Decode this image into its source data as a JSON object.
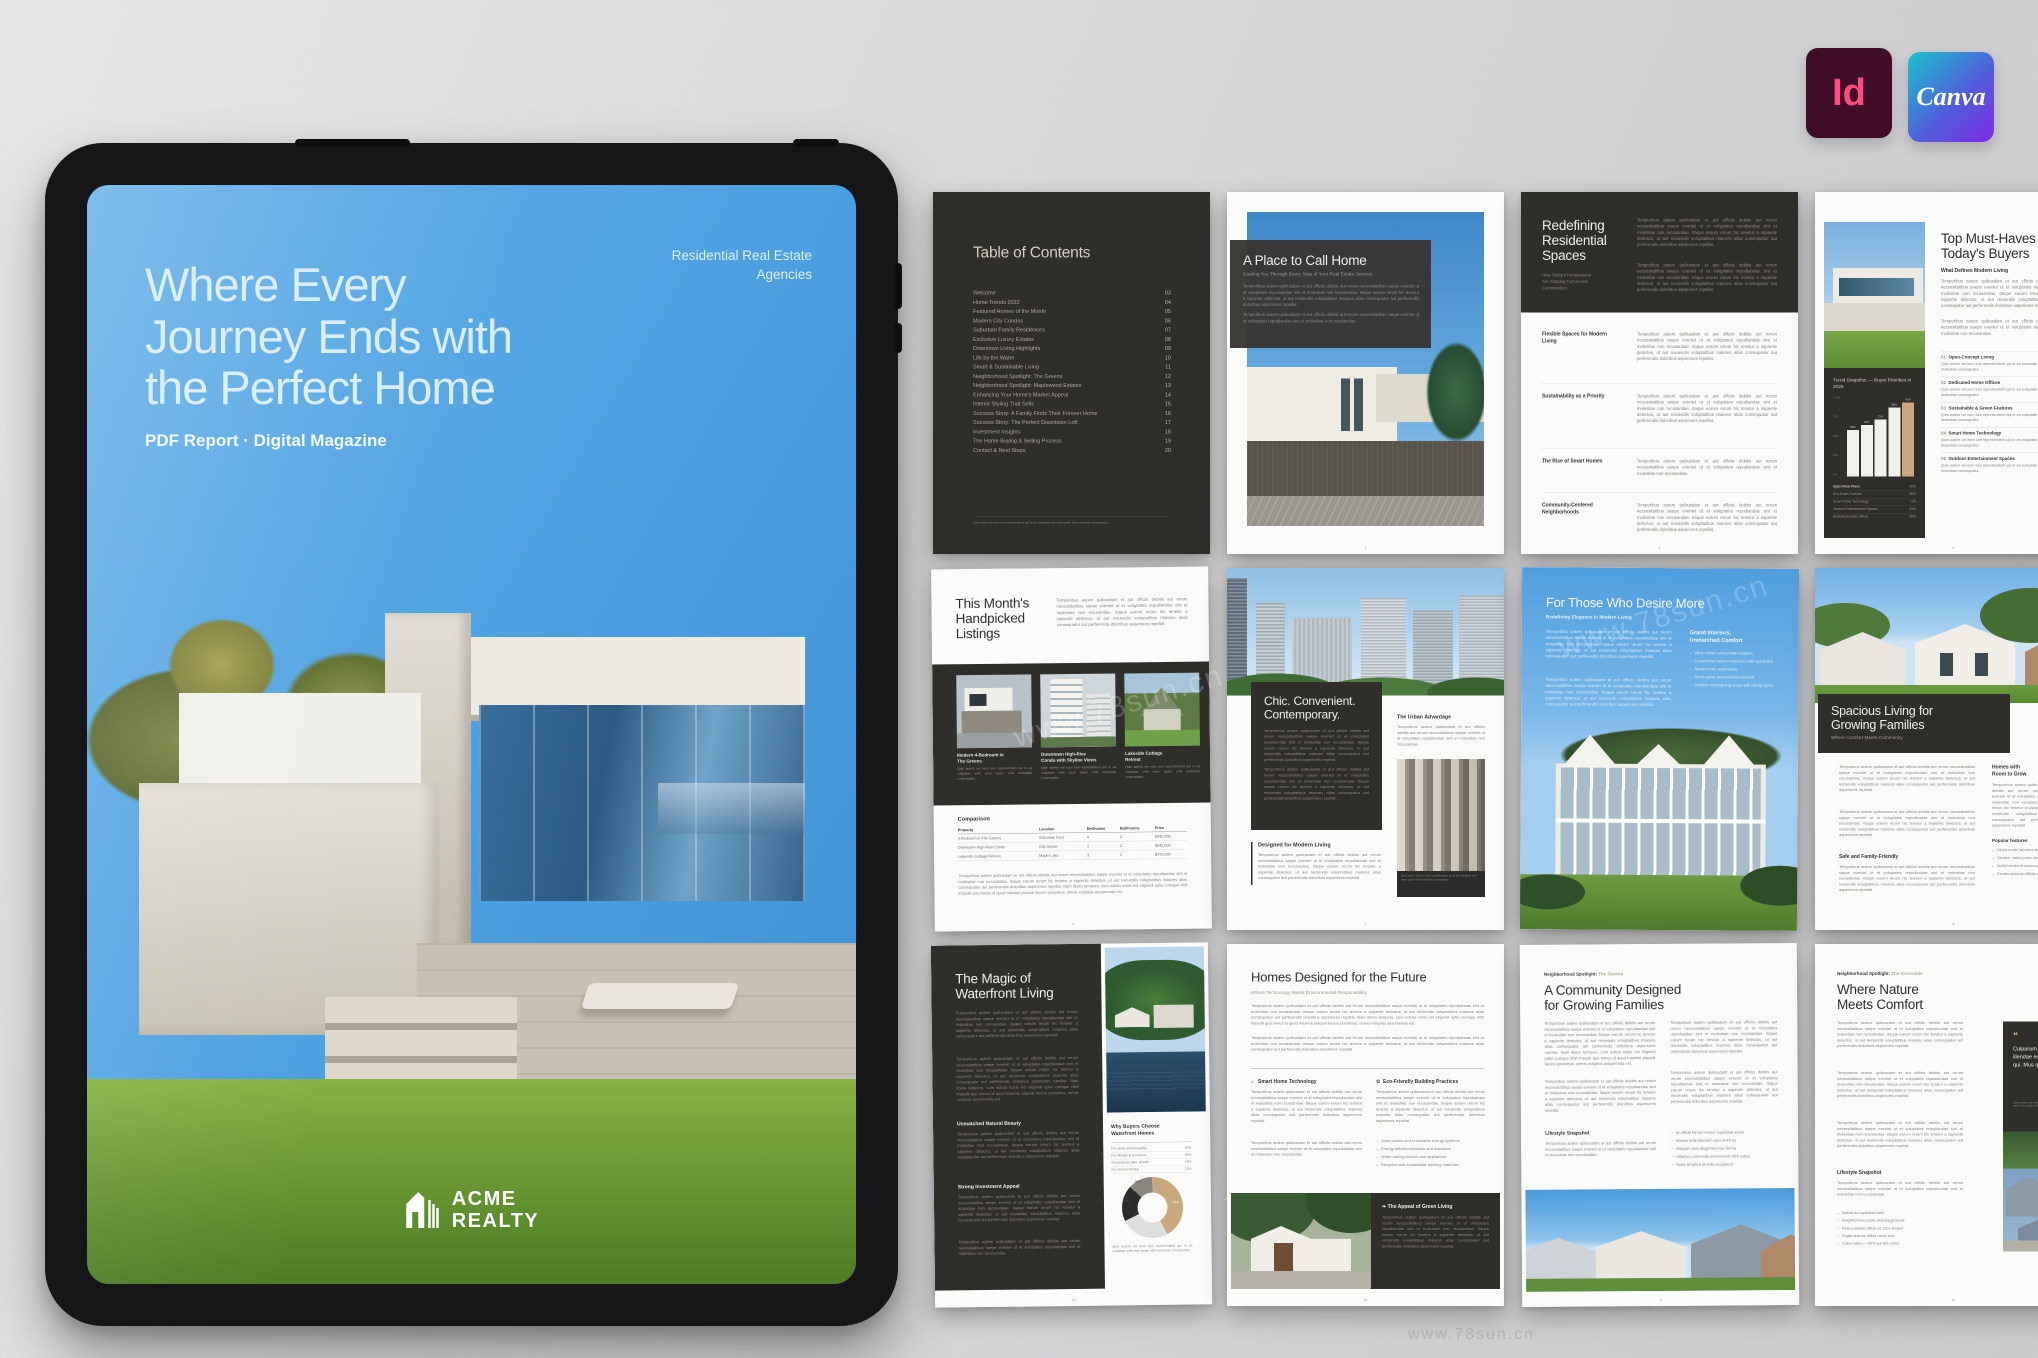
{
  "palette": {
    "accent_tan": "#c8a87e",
    "page_dark": "#302e2b",
    "sky_blue": "#4b9fe0"
  },
  "watermark": {
    "text": "www.78sun.cn"
  },
  "logos": {
    "indesign_label": "Id",
    "canva_label": "Canva"
  },
  "cover": {
    "title_lines": [
      "Where Every",
      "Journey Ends with",
      "the Perfect Home"
    ],
    "tagline": "PDF Report · Digital Magazine",
    "agency_lines": [
      "Residential Real Estate",
      "Agencies"
    ],
    "brand_line1": "ACME",
    "brand_line2": "REALTY"
  },
  "lorem": {
    "tiny": "Quis autem vel eum iure reprehenderit qui in ea voluptate velit esse quam nihil molestiae consequatur.",
    "s": "Temporibus autem quibusdam et aut officiis debitis aut rerum necessitatibus saepe eveniet ut et voluptates repudiandae sint et molestiae non recusandae.",
    "m": "Temporibus autem quibusdam et aut officiis debitis aut rerum necessitatibus saepe eveniet ut et voluptates repudiandae sint et molestiae non recusandae. Itaque earum rerum hic tenetur a sapiente delectus, ut aut reiciendis voluptatibus maiores alias consequatur aut perferendis doloribus asperiores repellat.",
    "l": "Temporibus autem quibusdam et aut officiis debitis aut rerum necessitatibus saepe eveniet ut et voluptates repudiandae sint et molestiae non recusandae. Itaque earum rerum hic tenetur a sapiente delectus, ut aut reiciendis voluptatibus maiores alias consequatur aut perferendis doloribus asperiores repellat. Nam libero tempore, cum soluta nobis est eligendi optio cumque nihil impedit quo minus id quod maxime placeat facere possimus, omnis voluptas assumenda est."
  },
  "toc": {
    "title": "Table of Contents",
    "items": [
      {
        "label": "Welcome",
        "page": "03"
      },
      {
        "label": "Home Trends 2032",
        "page": "04"
      },
      {
        "label": "Featured Homes of the Month",
        "page": "05"
      },
      {
        "label": "Modern City Condos",
        "page": "06"
      },
      {
        "label": "Suburban Family Residences",
        "page": "07"
      },
      {
        "label": "Exclusive Luxury Estates",
        "page": "08"
      },
      {
        "label": "Downtown Living Highlights",
        "page": "09"
      },
      {
        "label": "Life by the Water",
        "page": "10"
      },
      {
        "label": "Smart & Sustainable Living",
        "page": "11"
      },
      {
        "label": "Neighborhood Spotlight: The Greens",
        "page": "12"
      },
      {
        "label": "Neighborhood Spotlight: Maplewood Estates",
        "page": "13"
      },
      {
        "label": "Enhancing Your Home's Market Appeal",
        "page": "14"
      },
      {
        "label": "Interior Styling That Sells",
        "page": "15"
      },
      {
        "label": "Success Story: A Family Finds Their Forever Home",
        "page": "16"
      },
      {
        "label": "Success Story: The Perfect Downtown Loft",
        "page": "17"
      },
      {
        "label": "Investment Insights",
        "page": "18"
      },
      {
        "label": "The Home Buying & Selling Process",
        "page": "19"
      },
      {
        "label": "Contact & Next Steps",
        "page": "20"
      }
    ]
  },
  "place": {
    "title": "A Place to Call Home",
    "subtitle": "Guiding You Through Every Step of Your Real Estate Journey",
    "page_no": "3"
  },
  "redefining": {
    "title_lines": [
      "Redefining",
      "Residential",
      "Spaces"
    ],
    "subtitle_lines": [
      "How Today's Homebuyers",
      "Are Shaping Tomorrow's",
      "Communities"
    ],
    "sections": [
      "Flexible Spaces for Modern Living",
      "Sustainability as a Priority",
      "The Rise of Smart Homes",
      "Community-Centered Neighborhoods"
    ],
    "page_no": "4"
  },
  "musthaves": {
    "title_lines": [
      "Top Must-Haves for",
      "Today's Buyers"
    ],
    "kicker": "What Defines Modern Living",
    "items": [
      {
        "num": "01",
        "title": "Open-Concept Living"
      },
      {
        "num": "02",
        "title": "Dedicated Home Offices"
      },
      {
        "num": "03",
        "title": "Sustainable & Green Features"
      },
      {
        "num": "04",
        "title": "Smart Home Technology"
      },
      {
        "num": "05",
        "title": "Outdoor Entertainment Spaces"
      }
    ],
    "page_no": "5"
  },
  "listings": {
    "title_lines": [
      "This Month's",
      "Handpicked",
      "Listings"
    ],
    "cards": [
      {
        "title_lines": [
          "Modern 4-Bedroom in",
          "The Greens"
        ]
      },
      {
        "title_lines": [
          "Downtown High-Rise",
          "Condo with Skyline Views"
        ]
      },
      {
        "title_lines": [
          "Lakeside Cottage",
          "Retreat"
        ]
      }
    ],
    "comparison": {
      "label": "Comparison",
      "headers": [
        "Property",
        "Location",
        "Bedrooms",
        "Bathrooms",
        "Price"
      ],
      "rows": [
        [
          "4-Bedroom in The Greens",
          "Suburban East",
          "4",
          "3",
          "$940,000"
        ],
        [
          "Downtown High-Rise Condo",
          "City Center",
          "2",
          "2",
          "$545,000"
        ],
        [
          "Lakeside Cottage Retreat",
          "Maple Lake",
          "3",
          "2",
          "$725,000"
        ]
      ]
    },
    "page_no": "6"
  },
  "chic": {
    "title_lines": [
      "Chic. Convenient.",
      "Contemporary."
    ],
    "right_title": "The Urban Advantage",
    "bottom_title": "Designed for Modern Living",
    "page_no": "7"
  },
  "desire": {
    "title": "For Those Who Desire More",
    "subtitle": "Redefining Elegance in Modern Living",
    "panel_title_lines": [
      "Grand Interiors,",
      "Unmatched Comfort"
    ],
    "bullets": [
      "Wine cellars and private theaters",
      "Customized interior schemes with spa baths",
      "Smart home automation",
      "Home gyms and wellness retreats",
      "Outdoor entertaining areas with infinity pools"
    ]
  },
  "spacious": {
    "title_lines": [
      "Spacious Living for",
      "Growing Families"
    ],
    "subtitle": "Where Comfort Meets Community",
    "section": "Safe and Family-Friendly",
    "right_title_lines": [
      "Homes with",
      "Room to Grow"
    ],
    "right_section": "Popular features",
    "bullets": [
      "Litora morbi laborum analytics",
      "Veniam natus porta vestibulum",
      "Nulla hendrerit sociosqu moderatur",
      "Penatu animus officia caecus"
    ],
    "page_no": "8"
  },
  "waterfront": {
    "title_lines": [
      "The Magic of",
      "Waterfront Living"
    ],
    "section1": "Unmatched Natural Beauty",
    "section2": "Strong Investment Appeal",
    "panel_title_lines": [
      "Why Buyers Choose",
      "Waterfront Homes"
    ],
    "page_no": "10"
  },
  "future": {
    "title": "Homes Designed for the Future",
    "subtitle": "Where Technology Meets Environmental Responsibility",
    "col1_title": "Smart Home Technology",
    "col2_title": "Eco-Friendly Building Practices",
    "bullets": [
      "Solar panels and renewable energy systems",
      "Energy-efficient windows and insulation",
      "Water-saving fixtures and appliances",
      "Recycled and sustainable building materials"
    ],
    "green_title": "The Appeal of Green Living",
    "page_no": "11"
  },
  "community": {
    "eyebrow": "Neighborhood Spotlight:",
    "eyebrow_accent": "The Greens",
    "title_lines": [
      "A Community Designed",
      "for Growing Families"
    ],
    "section": "Lifestyle Snapshot",
    "bullets": [
      "Id officia forma tempor cupidatat sociis",
      "Mauris ante laborum quis enim eu",
      "Aliquam duis diligentes hac forma",
      "Ullamco commodo elementum nibh culpa",
      "Nulla simplicit id nulla excepteur"
    ],
    "page_no": "9"
  },
  "nature": {
    "eyebrow": "Neighborhood Spotlight:",
    "eyebrow_accent": "The Groveside",
    "title_lines": [
      "Where Nature",
      "Meets Comfort"
    ],
    "section": "Lifestyle Snapshot",
    "bullets": [
      "Natura ad cupidatat trails",
      "Neighborhood parks and playgrounds",
      "Rela curabitur officia us 120+ tempor",
      "Fugiat animus officia nersu eum",
      "Culpa natus — 93% qui sint codes"
    ],
    "quote": "Culparum tempore doluptaquo illendae ent et deseris voluptis qui. Mus quae excea dolore ea.",
    "page_no": "12"
  },
  "chart_data": [
    {
      "type": "bar",
      "title": "Trend Snapshot — Buyer Priorities in 2025",
      "categories": [
        "Dedicated Home Offices",
        "Outdoor Entertainment Spaces",
        "Smart Home Technology",
        "Eco-Smart Features",
        "Open Floor Plans"
      ],
      "values": [
        58,
        64,
        71,
        86,
        92
      ],
      "display": [
        "58%",
        "64%",
        "71%",
        "86%",
        "92%"
      ],
      "unit": "%",
      "ylim": [
        0,
        100
      ],
      "yticks": [
        "100%",
        "75%",
        "50%",
        "25%",
        "0%"
      ],
      "highlight_last_bar": true,
      "highlight_color": "#c8a87e",
      "legend_rows": [
        [
          "Open Floor Plans",
          "92%"
        ],
        [
          "Eco-Smart Features",
          "86%"
        ],
        [
          "Smart Home Technology",
          "71%"
        ],
        [
          "Outdoor Entertainment Spaces",
          "64%"
        ],
        [
          "Dedicated Home Offices",
          "58%"
        ]
      ]
    },
    {
      "type": "donut",
      "title": "Why Buyers Choose Waterfront Homes",
      "labels": [
        "For views and tranquility",
        "For lifestyle & recreation",
        "For property value growth",
        "For rental potential"
      ],
      "values": [
        42,
        26,
        19,
        13
      ],
      "display": [
        "42%",
        "26%",
        "19%",
        "13%"
      ],
      "colors": [
        "#c8a87e",
        "#dedede",
        "#2e2c2a",
        "#8a8680"
      ],
      "legend_position": "above"
    }
  ]
}
